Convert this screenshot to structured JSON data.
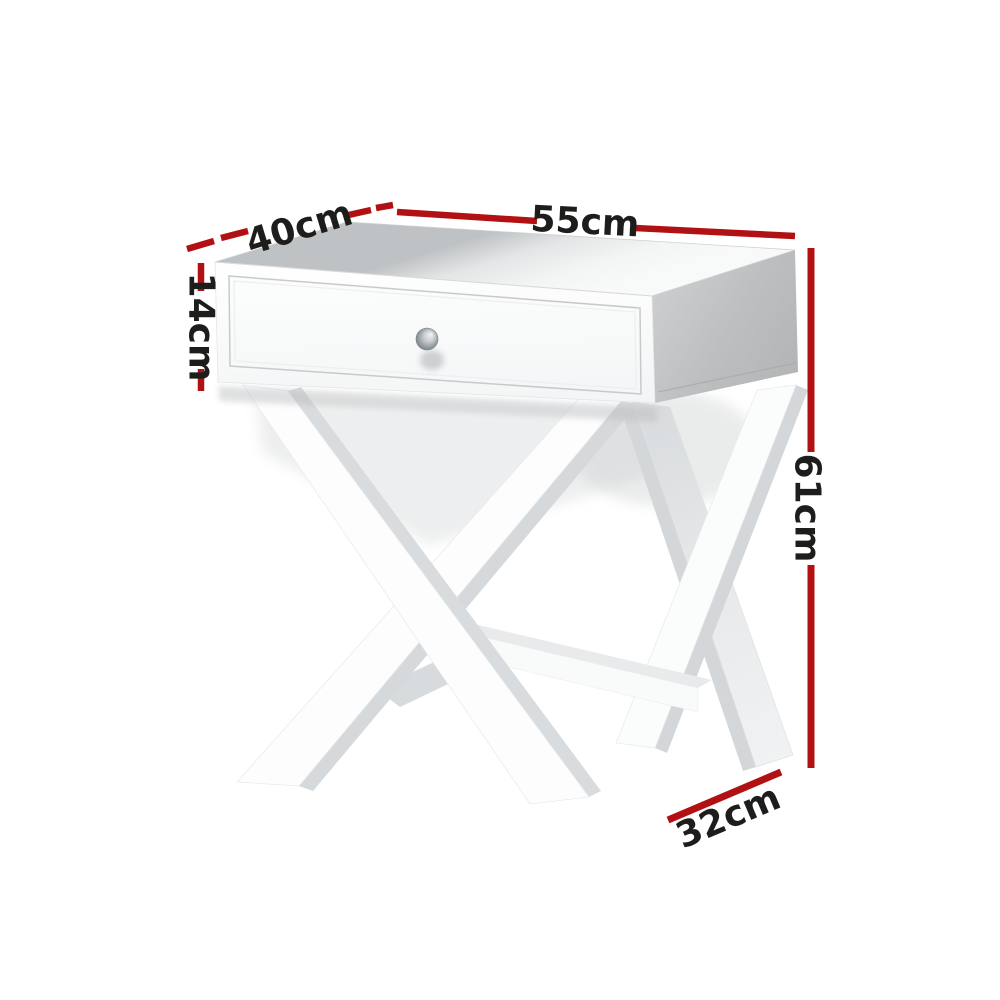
{
  "page": {
    "background": "#ffffff",
    "kind": "product dimension diagram"
  },
  "product": {
    "name": "White bedside table with single drawer, round metal knob and X-cross legs",
    "body_color": "white",
    "drawer_count": 1,
    "knob": "round metal knob"
  },
  "annotations": {
    "line_color": "#b21113",
    "text_color": "#1d1d1b",
    "labels": {
      "top_length": {
        "value": 55,
        "unit": "cm",
        "text": "55cm"
      },
      "top_depth": {
        "value": 40,
        "unit": "cm",
        "text": "40cm"
      },
      "tabletop_height": {
        "value": 14,
        "unit": "cm",
        "text": "14cm"
      },
      "overall_height": {
        "value": 61,
        "unit": "cm",
        "text": "61cm"
      },
      "foot_depth": {
        "value": 32,
        "unit": "cm",
        "text": "32cm"
      }
    }
  }
}
